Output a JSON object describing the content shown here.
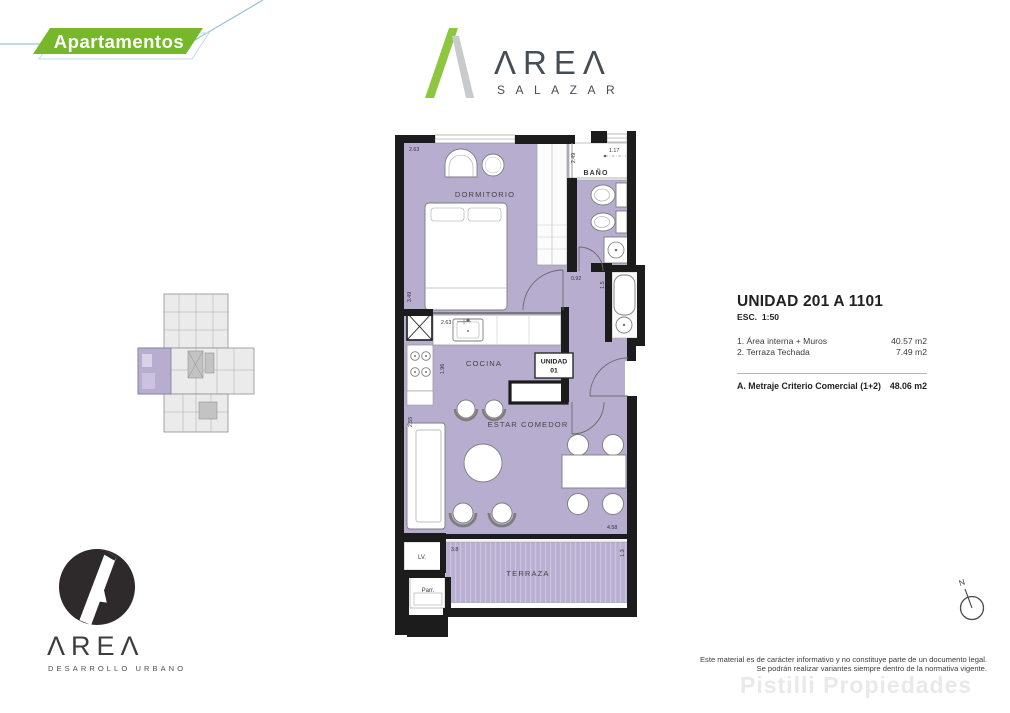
{
  "badge": {
    "label": "Apartamentos",
    "green": "#76b82a",
    "blue": "#9cc3da"
  },
  "brand": {
    "wordmark": "ΛREΛ",
    "name": "SALAZAR"
  },
  "floor_plan": {
    "rooms": {
      "bedroom": "DORMITORIO",
      "bath": "BAÑO",
      "kitchen": "COCINA",
      "living": "ESTAR COMEDOR",
      "terrace": "TERRAZA",
      "laundry": "LV.",
      "grill": "Parr."
    },
    "unit_box": {
      "line1": "UNIDAD",
      "line2": "01"
    },
    "dims": {
      "bedroom_top": "2.63",
      "bedroom_left": "3.49",
      "bath_left": "2.49",
      "bath_top": "1.17",
      "hall_door": "0.92",
      "hall_right": "1.5",
      "kitchen_top": "2.63",
      "kitchen_left": "1.96",
      "living_left": "2.55",
      "living_bottom": "4.58",
      "terrace_left": "3.8",
      "terrace_right": "1.3"
    },
    "floor_color": "#b7adcf"
  },
  "info_panel": {
    "title": "UNIDAD 201 A 1101",
    "scale": "ESC.  1:50",
    "items": [
      {
        "label": "1. Área interna + Muros",
        "value": "40.57 m2"
      },
      {
        "label": "2. Terraza Techada",
        "value": "7.49 m2"
      }
    ],
    "total": {
      "label": "A. Metraje Criterio Comercial (1+2)",
      "value": "48.06 m2"
    }
  },
  "footer_brand": {
    "wordmark": "ΛREΛ",
    "subtitle": "DESARROLLO URBANO"
  },
  "compass": {
    "north": "N"
  },
  "disclaimer": {
    "line1": "Este material es de carácter informativo y no constituye parte de un documento legal.",
    "line2": "Se podrán realizar variantes siempre dentro de la normativa vigente."
  },
  "watermark": "Pistilli Propiedades"
}
